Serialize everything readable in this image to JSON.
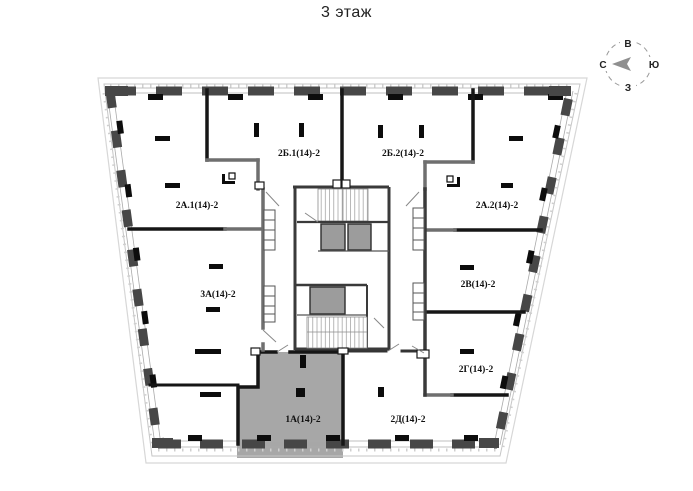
{
  "title": "3 этаж",
  "compass": {
    "top": "В",
    "right": "Ю",
    "bottom": "З",
    "left": "С"
  },
  "floor_plan": {
    "highlighted_apartment": "1А(14)-2",
    "apartments": [
      {
        "label": "2А.1(14)-2",
        "highlighted": false
      },
      {
        "label": "2Б.1(14)-2",
        "highlighted": false
      },
      {
        "label": "2Б.2(14)-2",
        "highlighted": false
      },
      {
        "label": "2А.2(14)-2",
        "highlighted": false
      },
      {
        "label": "3А(14)-2",
        "highlighted": false
      },
      {
        "label": "2В(14)-2",
        "highlighted": false
      },
      {
        "label": "2Г(14)-2",
        "highlighted": false
      },
      {
        "label": "1А(14)-2",
        "highlighted": true
      },
      {
        "label": "2Д(14)-2",
        "highlighted": false
      }
    ],
    "colors": {
      "wall": "#474747",
      "black": "#0d0d0d",
      "highlight": "#a7a7a7",
      "elevator": "#9c9c9c",
      "outline": "#c8c8c8",
      "compass_arrow": "#8f8f8f"
    }
  }
}
